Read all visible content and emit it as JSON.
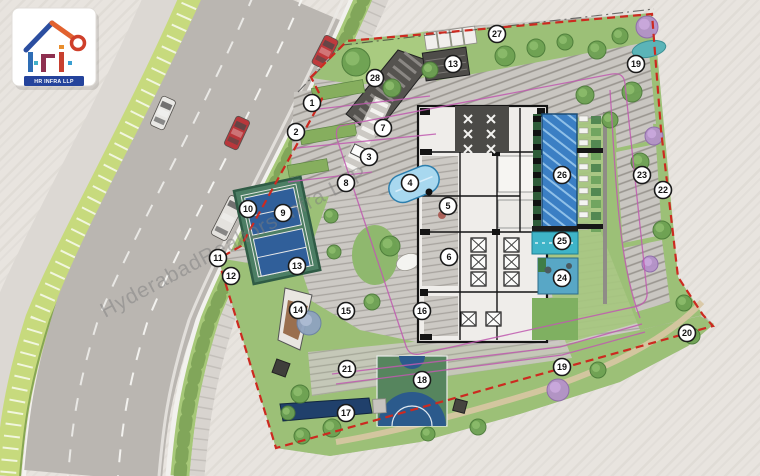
{
  "logo": {
    "brand": "HR INFRA LLP"
  },
  "watermark": {
    "text": "HyderabadRealtors Infra LLP"
  },
  "plan": {
    "colors": {
      "boundary": "#cc2a20",
      "setback": "#c05ab0",
      "asphalt": "#bab6b1",
      "lawn": "#9cc077",
      "pool_blue": "#3b7fc4",
      "pool_cyan": "#3fb4c8",
      "court_blue": "#305f9a",
      "court_green": "#4c7e64",
      "lap_pool_navy": "#20406b"
    },
    "markers": [
      {
        "n": "1",
        "x": 312,
        "y": 103
      },
      {
        "n": "2",
        "x": 296,
        "y": 132
      },
      {
        "n": "3",
        "x": 369,
        "y": 157
      },
      {
        "n": "4",
        "x": 410,
        "y": 183
      },
      {
        "n": "5",
        "x": 448,
        "y": 206
      },
      {
        "n": "6",
        "x": 449,
        "y": 257
      },
      {
        "n": "7",
        "x": 383,
        "y": 128
      },
      {
        "n": "8",
        "x": 346,
        "y": 183
      },
      {
        "n": "9",
        "x": 283,
        "y": 213
      },
      {
        "n": "10",
        "x": 248,
        "y": 209
      },
      {
        "n": "11",
        "x": 218,
        "y": 258
      },
      {
        "n": "12",
        "x": 231,
        "y": 276
      },
      {
        "n": "13",
        "x": 453,
        "y": 64
      },
      {
        "n": "13",
        "x": 297,
        "y": 266
      },
      {
        "n": "14",
        "x": 298,
        "y": 310
      },
      {
        "n": "15",
        "x": 346,
        "y": 311
      },
      {
        "n": "16",
        "x": 422,
        "y": 311
      },
      {
        "n": "17",
        "x": 346,
        "y": 413
      },
      {
        "n": "18",
        "x": 422,
        "y": 380
      },
      {
        "n": "19",
        "x": 636,
        "y": 64
      },
      {
        "n": "19",
        "x": 562,
        "y": 367
      },
      {
        "n": "20",
        "x": 687,
        "y": 333
      },
      {
        "n": "21",
        "x": 347,
        "y": 369
      },
      {
        "n": "22",
        "x": 663,
        "y": 190
      },
      {
        "n": "23",
        "x": 642,
        "y": 175
      },
      {
        "n": "24",
        "x": 562,
        "y": 278
      },
      {
        "n": "25",
        "x": 562,
        "y": 241
      },
      {
        "n": "26",
        "x": 562,
        "y": 175
      },
      {
        "n": "27",
        "x": 497,
        "y": 34
      },
      {
        "n": "28",
        "x": 375,
        "y": 78
      }
    ],
    "trees": [
      {
        "t": "g",
        "x": 356,
        "y": 62,
        "r": 14
      },
      {
        "t": "g",
        "x": 392,
        "y": 88,
        "r": 9
      },
      {
        "t": "g",
        "x": 430,
        "y": 70,
        "r": 8
      },
      {
        "t": "g",
        "x": 505,
        "y": 56,
        "r": 10
      },
      {
        "t": "g",
        "x": 536,
        "y": 48,
        "r": 9
      },
      {
        "t": "g",
        "x": 565,
        "y": 42,
        "r": 8
      },
      {
        "t": "g",
        "x": 597,
        "y": 50,
        "r": 9
      },
      {
        "t": "g",
        "x": 620,
        "y": 36,
        "r": 8
      },
      {
        "t": "p",
        "x": 647,
        "y": 27,
        "r": 11
      },
      {
        "t": "g",
        "x": 632,
        "y": 92,
        "r": 10
      },
      {
        "t": "p",
        "x": 654,
        "y": 136,
        "r": 9
      },
      {
        "t": "g",
        "x": 640,
        "y": 162,
        "r": 9
      },
      {
        "t": "g",
        "x": 662,
        "y": 230,
        "r": 9
      },
      {
        "t": "p",
        "x": 650,
        "y": 264,
        "r": 8
      },
      {
        "t": "g",
        "x": 684,
        "y": 303,
        "r": 8
      },
      {
        "t": "g",
        "x": 692,
        "y": 336,
        "r": 8
      },
      {
        "t": "p",
        "x": 558,
        "y": 390,
        "r": 11
      },
      {
        "t": "g",
        "x": 598,
        "y": 370,
        "r": 8
      },
      {
        "t": "g",
        "x": 478,
        "y": 427,
        "r": 8
      },
      {
        "t": "g",
        "x": 428,
        "y": 434,
        "r": 7
      },
      {
        "t": "g",
        "x": 332,
        "y": 428,
        "r": 9
      },
      {
        "t": "g",
        "x": 302,
        "y": 436,
        "r": 8
      },
      {
        "t": "b",
        "x": 309,
        "y": 323,
        "r": 12
      },
      {
        "t": "g",
        "x": 331,
        "y": 216,
        "r": 7
      },
      {
        "t": "g",
        "x": 334,
        "y": 252,
        "r": 7
      },
      {
        "t": "g",
        "x": 390,
        "y": 246,
        "r": 10
      },
      {
        "t": "g",
        "x": 372,
        "y": 302,
        "r": 8
      },
      {
        "t": "g",
        "x": 300,
        "y": 394,
        "r": 9
      },
      {
        "t": "g",
        "x": 288,
        "y": 413,
        "r": 7
      },
      {
        "t": "g",
        "x": 585,
        "y": 95,
        "r": 9
      },
      {
        "t": "g",
        "x": 610,
        "y": 120,
        "r": 8
      }
    ],
    "cars": [
      {
        "x": 325,
        "y": 52,
        "rot": 27,
        "color": "#bf3a3d",
        "kind": "car"
      },
      {
        "x": 163,
        "y": 113,
        "rot": 24,
        "color": "#e9e8e5",
        "kind": "car"
      },
      {
        "x": 237,
        "y": 133,
        "rot": 25,
        "color": "#b8373b",
        "kind": "car"
      },
      {
        "x": 228,
        "y": 218,
        "rot": 27,
        "color": "#e4e2de",
        "kind": "bus"
      }
    ]
  }
}
